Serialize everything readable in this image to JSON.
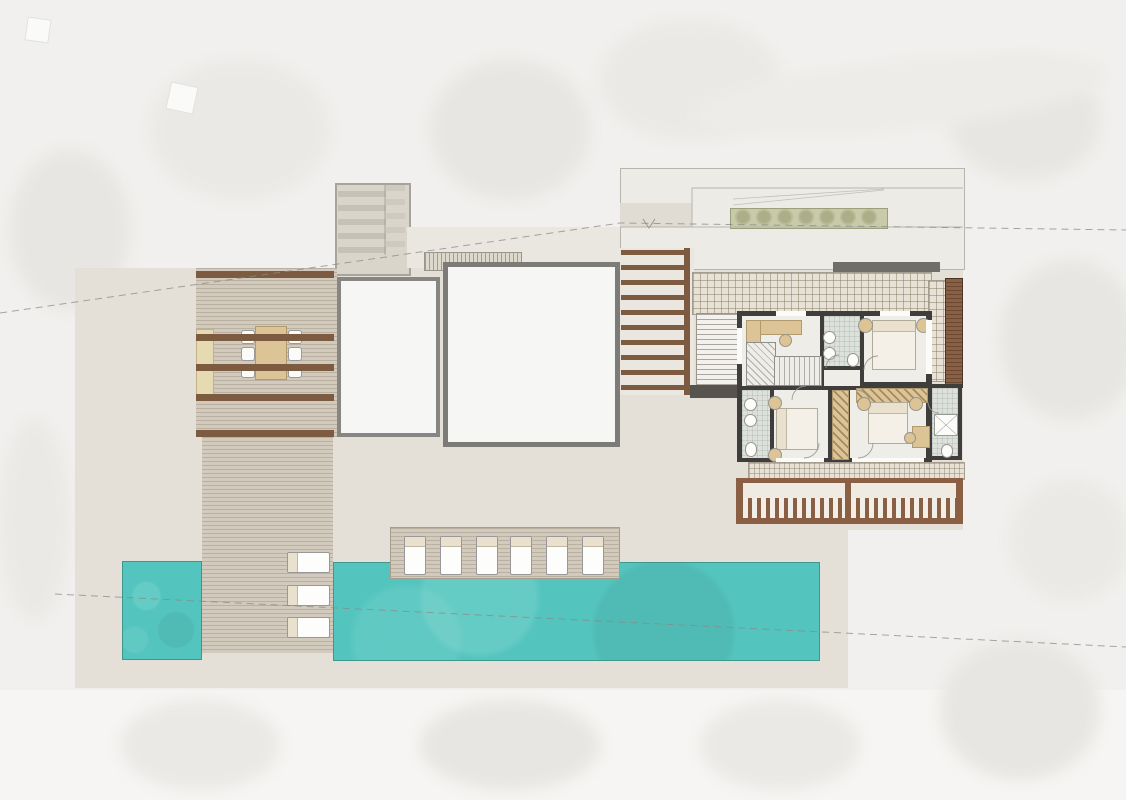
{
  "palette": {
    "bg": "#f1f0ee",
    "bgLight": "#f6f5f3",
    "blob": "#e7e6e2",
    "pad": "#e4e0d8",
    "roof": "#edebe5",
    "roofBand": "#e0dcd3",
    "band": "#eae7e0",
    "tower": "#d9d5ca",
    "whiteRoof": "#f6f6f4",
    "squareBorder": "#878683",
    "deck": "#d2cabc",
    "beam": "#7d5b41",
    "balconyWood": "#8a5f43",
    "tile": "#e8e2d6",
    "wall": "#3f3e3c",
    "roomFloor": "#efede8",
    "bathFloor": "#dce1dc",
    "tan": "#dcc496",
    "pool": "#54c5be",
    "poolEdge": "#3e978f",
    "planting": "#c9cba8",
    "plantingDot": "#a6aa82",
    "lounger": "#fdfdfc",
    "loungerBand": "#e9e1cd",
    "darkBar": "#6f6e6b",
    "outline": "#b8b5ad",
    "boundary": "#8a8a86"
  },
  "site": {
    "plan_type": "villa-upper-floor-site-plan",
    "pool": {
      "color": "#54c5be",
      "sections": 2
    },
    "sun_loungers_poolside": {
      "count": 6
    },
    "sun_loungers_walkway": {
      "count": 3
    },
    "dining_set": {
      "chairs": 6,
      "tables": 1
    },
    "planted_roof_strip": {
      "plant_count": 7
    },
    "pergola_left": {
      "beam_count": 5
    },
    "pergola_mid": {
      "beam_count": 10
    },
    "stair_tower": {
      "tread_count": 5
    },
    "rooms": [
      {
        "name": "hall-stairs"
      },
      {
        "name": "bathroom-north"
      },
      {
        "name": "bedroom-northeast"
      },
      {
        "name": "bathroom-west"
      },
      {
        "name": "bedroom-southwest"
      },
      {
        "name": "bedroom-southeast"
      },
      {
        "name": "bathroom-ensuite"
      }
    ],
    "beds": 3,
    "wardrobes": 2,
    "outdoor_staircases": 2,
    "roof_skylights": 2
  }
}
